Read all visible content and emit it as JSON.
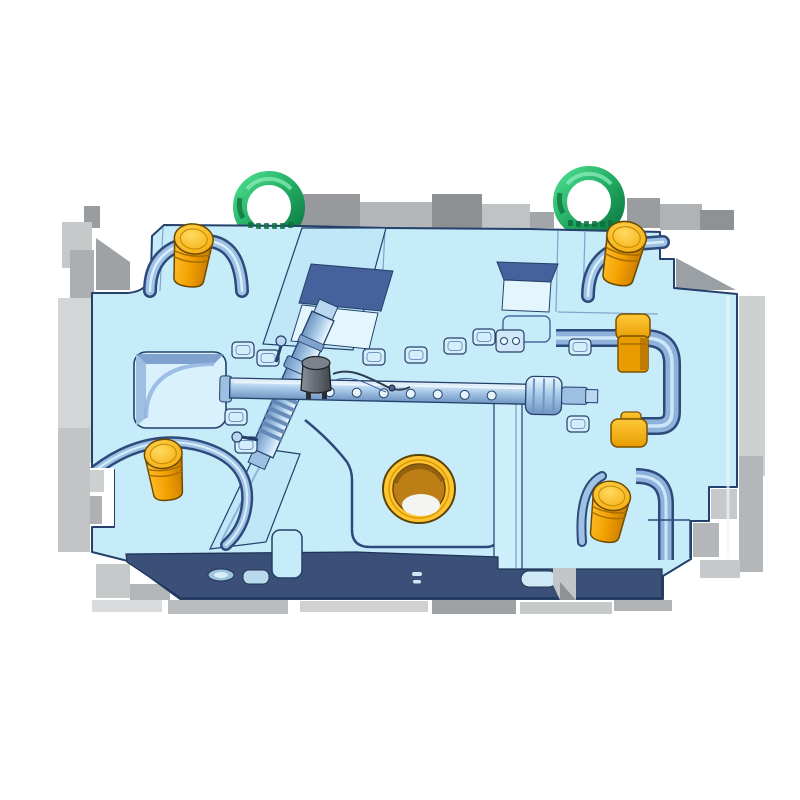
{
  "meta": {
    "title": "3D CAD render of an injection mold base plate with molded part cavity",
    "background": "#ffffff"
  },
  "colors": {
    "plate_face": "#c6ecf9",
    "plate_outline": "#24406b",
    "plate_band_dark": "#3a5078",
    "band_outline": "#1e3355",
    "channel_face": "#c0e7f7",
    "recess_dark": "#46619b",
    "recess_light": "#e4f6fd",
    "groove_steel": "#8fb2dd",
    "pocket_floor": "#d8f1fc",
    "pin_body": "#f2a500",
    "pin_cap": "#ffc53d",
    "pin_outline": "#6b4a00",
    "bushing_gold": "#ffc431",
    "bushing_bore": "#bd7e16",
    "bushing_highlight": "#f4f4f2",
    "block_orange": "#f5ae00",
    "ring_green": "#2fbf71",
    "ring_green_dark": "#117a45",
    "part_metal_light": "#cfe4f6",
    "part_metal_mid": "#9dbfe2",
    "part_metal_dark": "#5f85b4",
    "cap_gray": "#5d636c",
    "shadow_gray": "#a8abae"
  },
  "components": {
    "plate_label": "Mold base plate",
    "ring_label": "Lifting ring",
    "pin_label": "Guide pin",
    "block_label": "Side lock block",
    "bushing_label": "Locating ring bore",
    "part_label": "Molded part in cavity",
    "rail_label": "Ejector rail",
    "shadow_label": "Shadow block"
  },
  "counts": {
    "lifting_rings": 2,
    "guide_pins": 4,
    "orange_side_blocks": 2,
    "rack_holes": 7
  }
}
